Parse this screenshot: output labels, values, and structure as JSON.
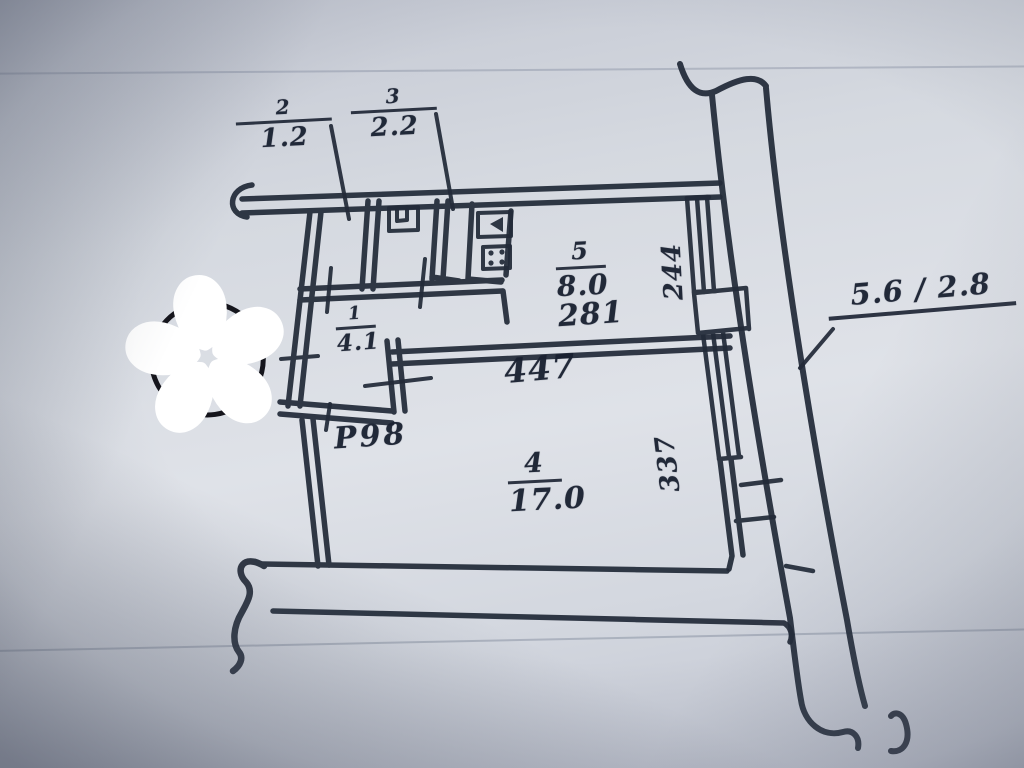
{
  "plan": {
    "title_hint": "apartment floor plan",
    "rooms": [
      {
        "number": "2",
        "area": "1.2"
      },
      {
        "number": "3",
        "area": "2.2"
      },
      {
        "number": "5",
        "area": "8.0"
      },
      {
        "number": "1",
        "area": "4.1"
      },
      {
        "number": "4",
        "area": "17.0"
      }
    ],
    "dimensions": {
      "room5_width": "281",
      "room4_width": "447",
      "window_upper": "244",
      "window_lower": "337",
      "doorway": "Р98",
      "external_wall": "5.6 / 2.8"
    }
  },
  "colors": {
    "ink": "#222a38",
    "paper_light": "#dfe2e8",
    "paper_shadow": "#7e8495",
    "watermark_outline": "#ffffff",
    "watermark_core": "#0e0e12"
  },
  "watermark": {
    "shape": "five-petal-asterisk-flower"
  }
}
